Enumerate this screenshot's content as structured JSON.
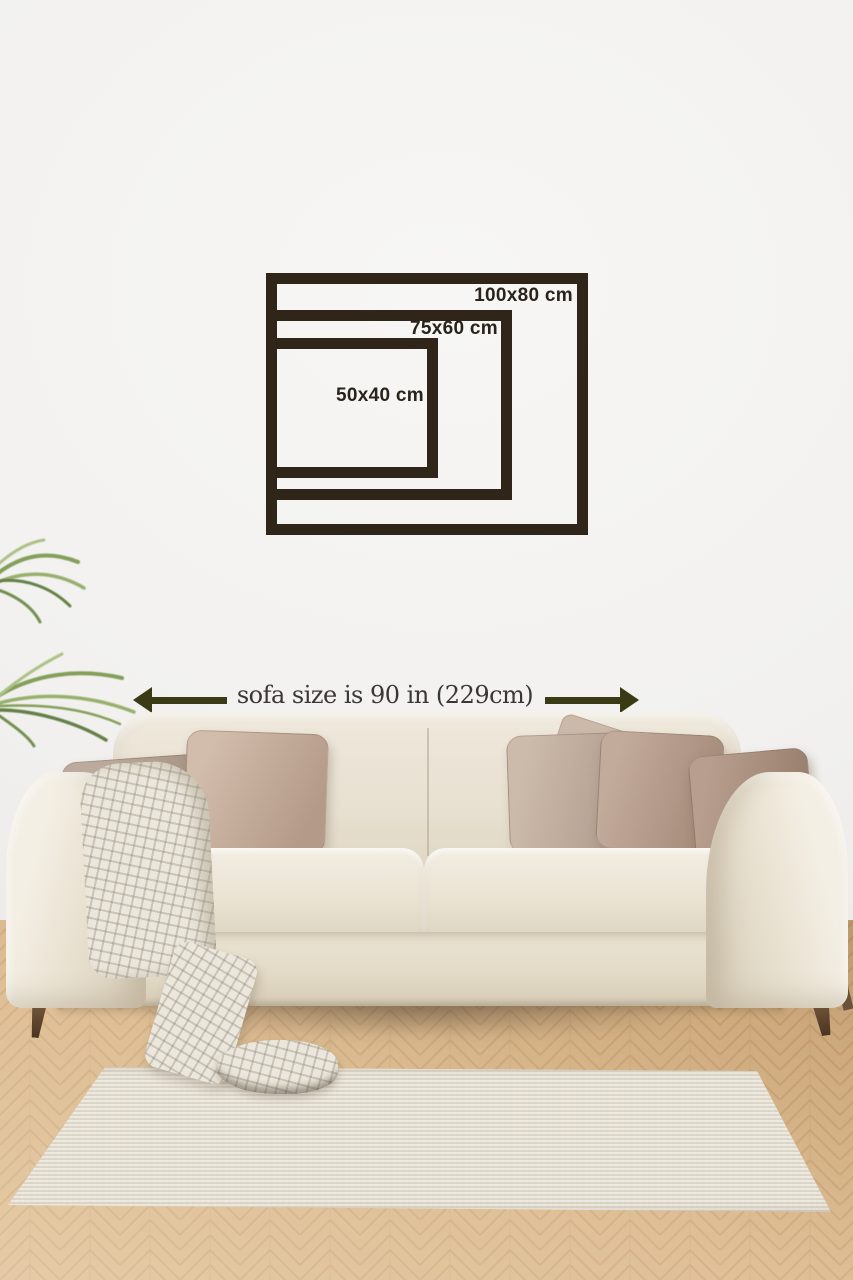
{
  "size_guide": {
    "frames": [
      {
        "label": "100x80 cm"
      },
      {
        "label": "75x60 cm"
      },
      {
        "label": "50x40 cm"
      }
    ]
  },
  "measurement": {
    "label": "sofa size is 90 in (229cm)",
    "left_icon": "left-arrow-icon",
    "right_icon": "right-arrow-icon"
  },
  "palette": {
    "frame_color": "#302519",
    "frame_label_color": "#2a231c",
    "arrow_color": "#3a3a15",
    "measurement_text_color": "#3a3734",
    "wall": "#f2f1ef",
    "sofa_fabric": "#e9e2d2",
    "floor_wood": "#d7b384",
    "rug": "#e4ded1",
    "pillow_taupe": "#b49b89",
    "plant_green": "#7f9b52",
    "leg_wood": "#6b5138"
  }
}
